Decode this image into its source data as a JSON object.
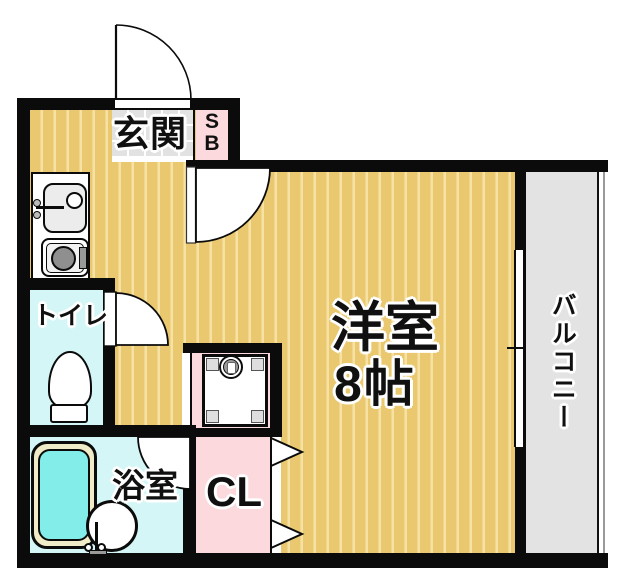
{
  "rooms": {
    "entrance": {
      "label": "玄関"
    },
    "shoe_box": {
      "line1": "S",
      "line2": "B"
    },
    "toilet": {
      "label": "トイレ"
    },
    "bathroom": {
      "label": "浴室"
    },
    "closet": {
      "label": "CL"
    },
    "main_room": {
      "label": "洋室",
      "size": "8帖"
    },
    "balcony": {
      "label": "バルコニー"
    }
  },
  "colors": {
    "wall": "#0b0b0b",
    "wood_floor": "#eac86f",
    "wood_stripe": "#f6e2a4",
    "entrance_tile_gray": "#e2e2e2",
    "balcony_gray": "#e3e3e3",
    "wet_room_cyan": "#d5f6f6",
    "bath_water_cyan": "#83edea",
    "tub_rim_cream": "#f1ecc8",
    "storage_pink": "#fbd9dc"
  }
}
